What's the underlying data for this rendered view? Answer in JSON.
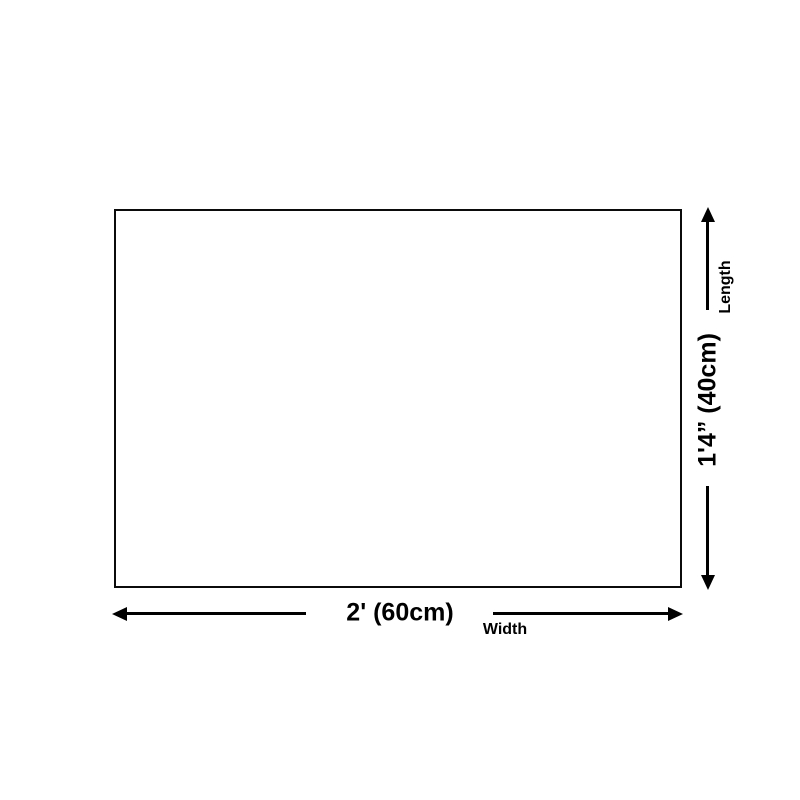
{
  "page": {
    "background": "#ffffff",
    "line_color": "#000000",
    "text_color": "#000000"
  },
  "diagram": {
    "width": {
      "value": "2' (60cm)",
      "caption": "Width"
    },
    "length": {
      "value": "1'4” (40cm)",
      "caption": "Length"
    }
  }
}
